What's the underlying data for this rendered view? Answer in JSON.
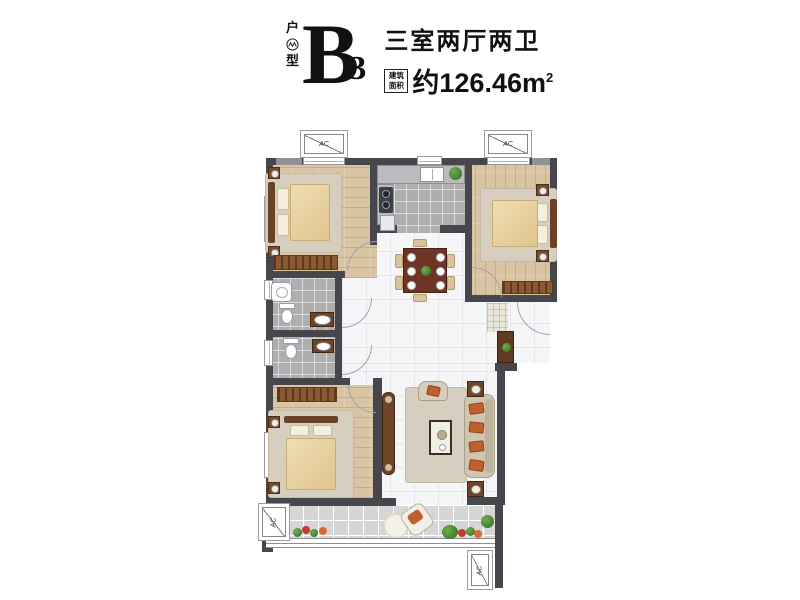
{
  "header": {
    "type_label_top": "户",
    "type_label_bottom": "型",
    "unit_letter": "B",
    "unit_number": "3",
    "rooms_summary": "三室两厅两卫",
    "area_badge_line1": "建筑",
    "area_badge_line2": "面积",
    "area_prefix": "约",
    "area_value": "126.46",
    "area_unit": "m",
    "area_superscript": "2"
  },
  "plan": {
    "ac_label": "AC",
    "colors": {
      "wall": "#46464c",
      "wood": "#d9c4a4",
      "tile": "#aeaeae",
      "marble": "#f5f6f8",
      "balcony": "#d6d6d6",
      "duvet": "#dfc48e",
      "furniture": "#8a5a33",
      "sofa": "#cfc6b2",
      "orange": "#c06030",
      "green": "#3f7a2e",
      "rug": "#d6cfc0"
    }
  }
}
